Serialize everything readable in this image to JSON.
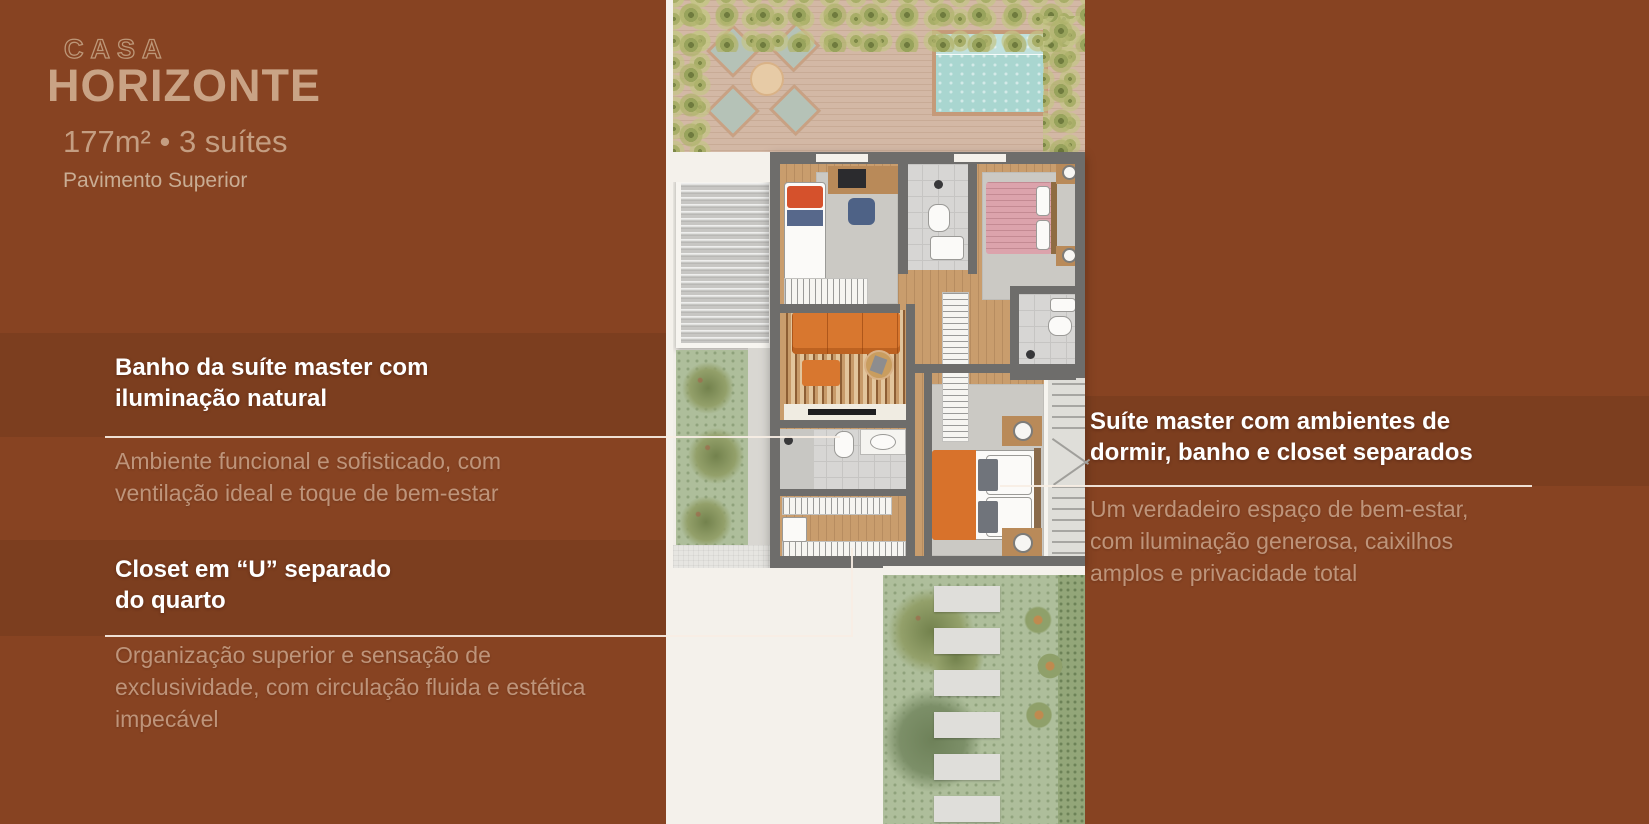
{
  "brand": {
    "kicker": "CASA",
    "title": "HORIZONTE",
    "specs": "177m² • 3 suítes",
    "floor_label": "Pavimento Superior"
  },
  "callouts": {
    "bath_master": {
      "heading": "Banho da suíte master com\niluminação natural",
      "body": "Ambiente funcional e sofisticado, com\nventilação ideal e toque de bem-estar"
    },
    "closet": {
      "heading": "Closet em “U” separado\ndo quarto",
      "body": "Organização superior e sensação de\nexclusividade, com circulação fluida e estética\nimpecável"
    },
    "suite_master": {
      "heading": "Suíte master com ambientes de\ndormir, banho e closet separados",
      "body": "Um verdadeiro espaço de bem-estar,\ncom iluminação generosa, caixilhos\namplos e privacidade total"
    }
  },
  "colors": {
    "background": "#874322",
    "brand_tan": "#C9A385",
    "heading_white": "#FFFFFF",
    "body_text": "#BE947A",
    "leader_line": "#F7EEE4",
    "pool_water": "#A9D6D0",
    "deck_wood": "#D3B8A5",
    "garden_green": "#AEBE9B",
    "sofa_orange": "#D8772F",
    "wall_gray": "#6E6D6B"
  }
}
